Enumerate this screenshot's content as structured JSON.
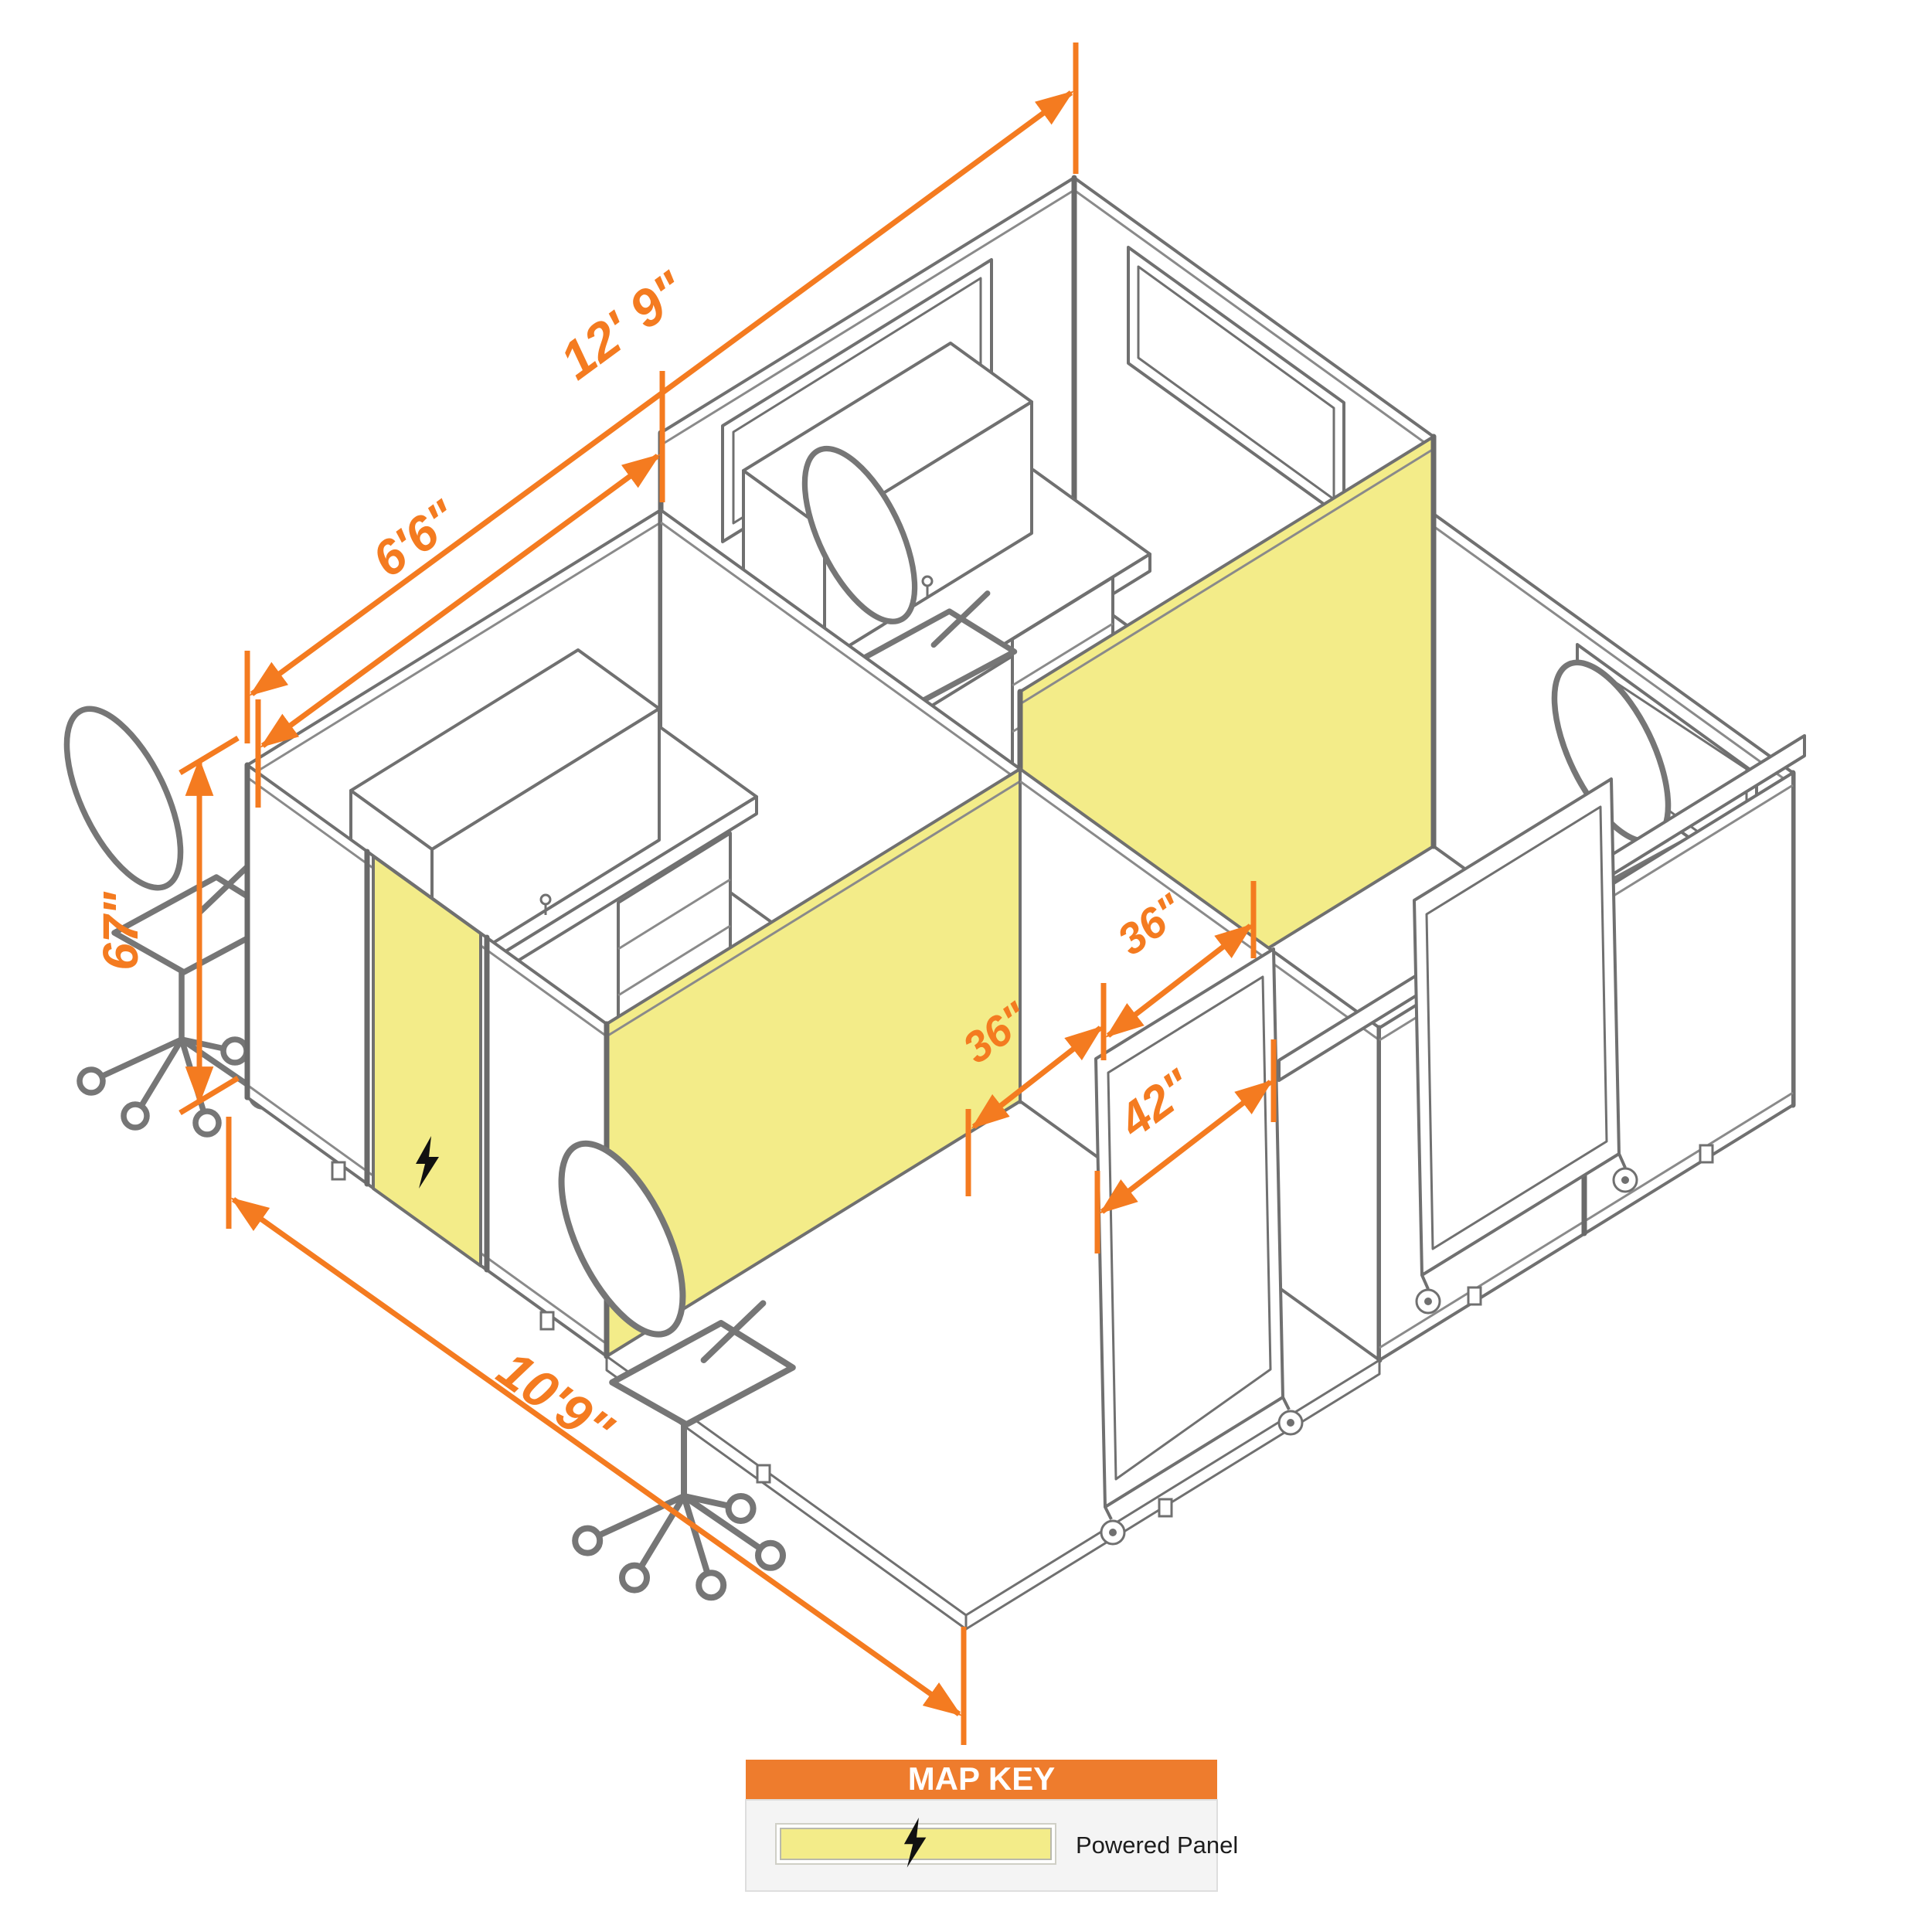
{
  "drawing": {
    "type": "isometric-cubicle-floorplan",
    "units": "feet-inches",
    "dimensions": {
      "total_depth_label": "12' 9\"",
      "cubicle_depth_label": "6'6\"",
      "panel_height_label": "67\"",
      "total_width_label": "10'9\"",
      "left_opening_label": "36\"",
      "right_opening_label": "36\"",
      "mobile_panel_label": "42\""
    },
    "colors": {
      "dimension_orange": "#F47B20",
      "powered_panel_yellow": "#F3EC89",
      "line_gray": "#707070",
      "key_header_orange": "#EE7C2D"
    }
  },
  "map_key": {
    "title": "MAP KEY",
    "items": [
      {
        "swatch": "powered-panel",
        "label": "Powered Panel"
      }
    ]
  }
}
